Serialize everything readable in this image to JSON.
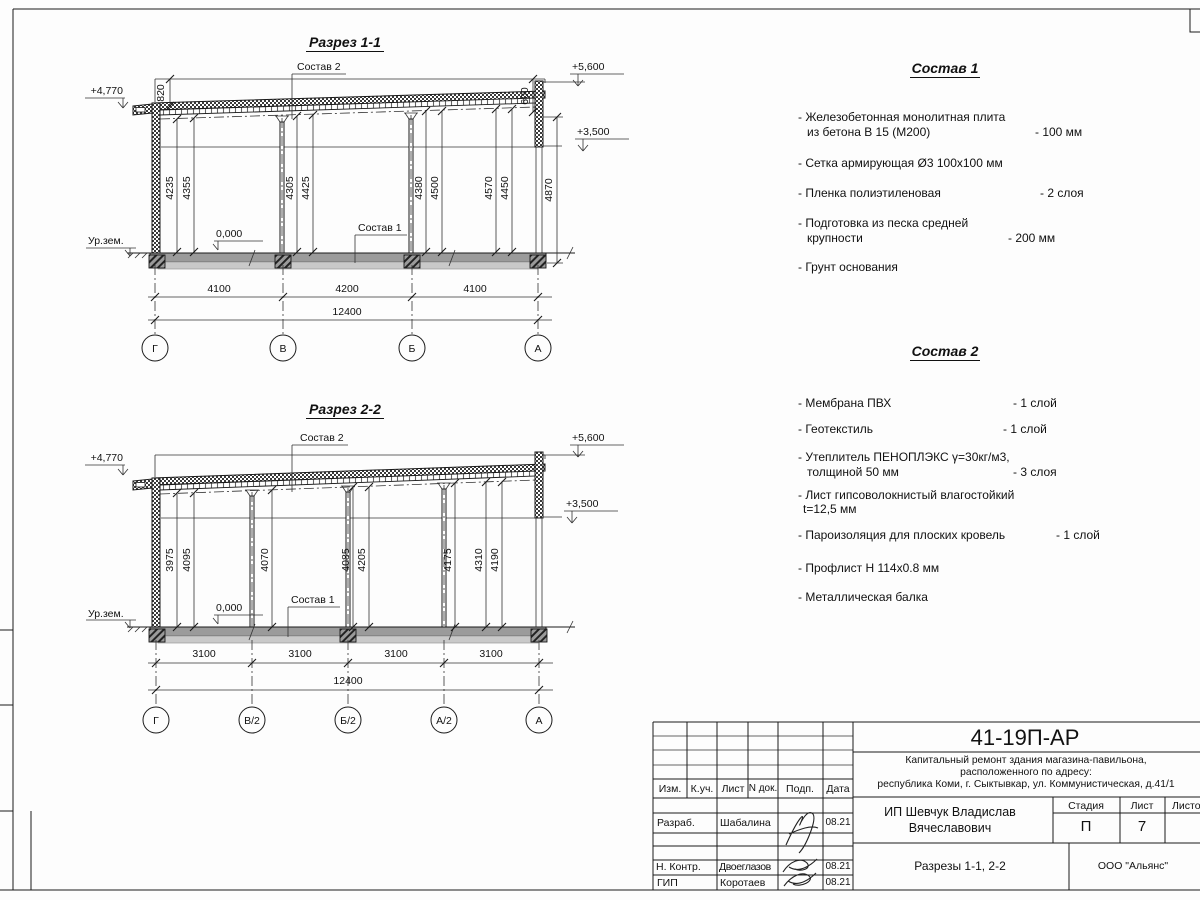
{
  "sections": {
    "s1": {
      "title": "Разрез 1-1",
      "elev_plus4770": "+4,770",
      "elev_plus5600": "+5,600",
      "elev_plus3500": "+3,500",
      "ground": "Ур.зем.",
      "zero": "0,000",
      "leader_sostav1": "Состав 1",
      "leader_sostav2": "Состав 2",
      "dim_820": "820",
      "dim_600": "600",
      "dim_4870": "4870",
      "vdims": [
        "4235",
        "4355",
        "4305",
        "4425",
        "4380",
        "4500",
        "4570",
        "4450"
      ],
      "hdims": [
        "4100",
        "4200",
        "4100"
      ],
      "total": "12400",
      "axes": [
        "Г",
        "В",
        "Б",
        "А"
      ]
    },
    "s2": {
      "title": "Разрез 2-2",
      "elev_plus4770": "+4,770",
      "elev_plus5600": "+5,600",
      "elev_plus3500": "+3,500",
      "ground": "Ур.зем.",
      "zero": "0,000",
      "leader_sostav1": "Состав 1",
      "leader_sostav2": "Состав 2",
      "vdims": [
        "3975",
        "4095",
        "4070",
        "4085",
        "4205",
        "4175",
        "4310",
        "4190"
      ],
      "hdims": [
        "3100",
        "3100",
        "3100",
        "3100"
      ],
      "total": "12400",
      "axes": [
        "Г",
        "В/2",
        "Б/2",
        "А/2",
        "А"
      ]
    }
  },
  "spec1": {
    "title": "Состав 1",
    "items": [
      {
        "l1": "- Железобетонная  монолитная плита",
        "l2": "из бетона В 15 (М200)",
        "value": "- 100 мм"
      },
      {
        "l1": "- Сетка армирующая Ø3 100х100 мм"
      },
      {
        "l1": "- Пленка полиэтиленовая",
        "value": "- 2 слоя"
      },
      {
        "l1": "- Подготовка из песка средней",
        "l2": "крупности",
        "value": "- 200 мм"
      },
      {
        "l1": "- Грунт основания"
      }
    ]
  },
  "spec2": {
    "title": "Состав 2",
    "items": [
      {
        "l1": "- Мембрана ПВХ",
        "value": "- 1 слой"
      },
      {
        "l1": "- Геотекстиль",
        "value": "- 1 слой"
      },
      {
        "l1": "- Утеплитель ПЕНОПЛЭКС γ=30кг/м3,",
        "l2": "толщиной 50 мм",
        "value": "- 3 слоя"
      },
      {
        "l1": "- Лист гипсоволокнистый влагостойкий",
        "l2": "t=12,5 мм"
      },
      {
        "l1": "- Пароизоляция для плоских кровель",
        "value": "- 1 слой"
      },
      {
        "l1": "- Профлист Н 114х0.8 мм"
      },
      {
        "l1": "- Металлическая балка"
      }
    ]
  },
  "titleblock": {
    "code": "41-19П-АР",
    "project_line1": "Капитальный ремонт здания магазина-павильона,",
    "project_line2": "расположенного по адресу:",
    "project_line3": "республика Коми, г. Сыктывкар, ул. Коммунистическая, д.41/1",
    "client_line1": "ИП Шевчук Владислав",
    "client_line2": "Вячеславович",
    "stage_label": "Стадия",
    "sheet_label": "Лист",
    "sheets_label": "Листо",
    "stage": "П",
    "sheet": "7",
    "doc_title": "Разрезы 1-1, 2-2",
    "org": "ООО \"Альянс\"",
    "cols": [
      "Изм.",
      "К.уч.",
      "Лист",
      "N док.",
      "Подп.",
      "Дата"
    ],
    "rows": [
      {
        "role": "Разраб.",
        "name": "Шабалина",
        "date": "08.21"
      },
      {
        "role": "Н. Контр.",
        "name": "Двоеглазов",
        "date": "08.21"
      },
      {
        "role": "ГИП",
        "name": "Коротаев",
        "date": "08.21"
      }
    ]
  }
}
